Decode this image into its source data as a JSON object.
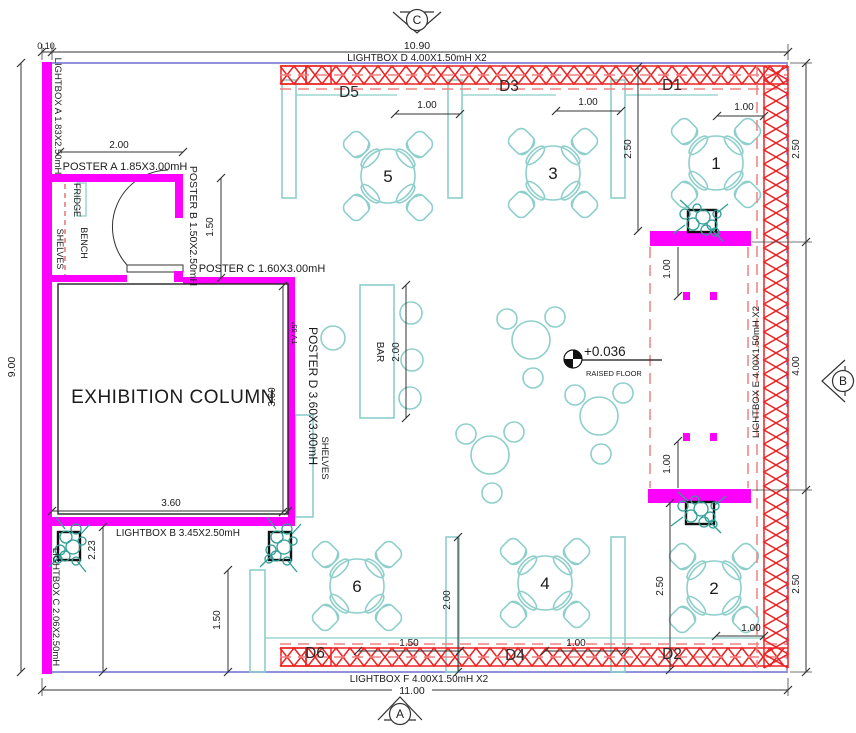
{
  "colors": {
    "wall_magenta": "#FF00FF",
    "truss_red": "#EE2222",
    "dashed_red": "#F28080",
    "furniture_cyan": "#8ECFCB",
    "plant_teal": "#2E9E96",
    "boundary_purple": "#9191DC",
    "ink": "#1B1B1B"
  },
  "markers": {
    "top": "C",
    "right": "B",
    "bottom": "A"
  },
  "labels": {
    "exhibition_column": "EXHIBITION COLUMN",
    "bar": "BAR",
    "fridge": "FRIDGE",
    "bench": "BENCH",
    "shelves_storage": "SHELVES",
    "shelves_wall": "SHELVES",
    "tv": "TV 65''",
    "level_value": "+0.036",
    "level_label": "RAISED FLOOR",
    "poster_a": "POSTER A 1.85X3.00mH",
    "poster_b": "POSTER B 1.50X2.50mH",
    "poster_c": "POSTER C 1.60X3.00mH",
    "poster_d": "POSTER D 3.60X3.00mH",
    "lightbox_a": "LIGHTBOX A 1.83X2.50mH",
    "lightbox_b": "LIGHTBOX B 3.45X2.50mH",
    "lightbox_c": "LIGHTBOX C 2.06X2.50mH",
    "lightbox_d": "LIGHTBOX D 4.00X1.50mH X2",
    "lightbox_e": "LIGHTBOX E 4.00X1.50mH X2",
    "lightbox_f": "LIGHTBOX F 4.00X1.50mH X2",
    "d1": "D1",
    "d2": "D2",
    "d3": "D3",
    "d4": "D4",
    "d5": "D5",
    "d6": "D6",
    "t1": "1",
    "t2": "2",
    "t3": "3",
    "t4": "4",
    "t5": "5",
    "t6": "6"
  },
  "dims": {
    "top_offset": "0.10",
    "top_width": "10.90",
    "bottom_width": "11.00",
    "left_height": "9.00",
    "right_top": "2.50",
    "right_mid": "4.00",
    "right_bottom": "2.50",
    "inner_right_top": "2.50",
    "inner_right_bottom": "2.50",
    "gap_t5": "1.00",
    "gap_t3": "1.00",
    "gap_t1": "1.00",
    "corridor_top": "1.00",
    "corridor_bottom": "1.00",
    "poster_a_width": "2.00",
    "poster_b_height": "1.50",
    "column_width": "3.60",
    "column_height": "3.60",
    "lightbox_c_height": "2.23",
    "partition_left": "1.50",
    "partition_mid": "2.00",
    "bar_length": "2.00",
    "gap_d6": "1.50",
    "gap_d4": "1.00",
    "gap_t2": "1.00"
  }
}
